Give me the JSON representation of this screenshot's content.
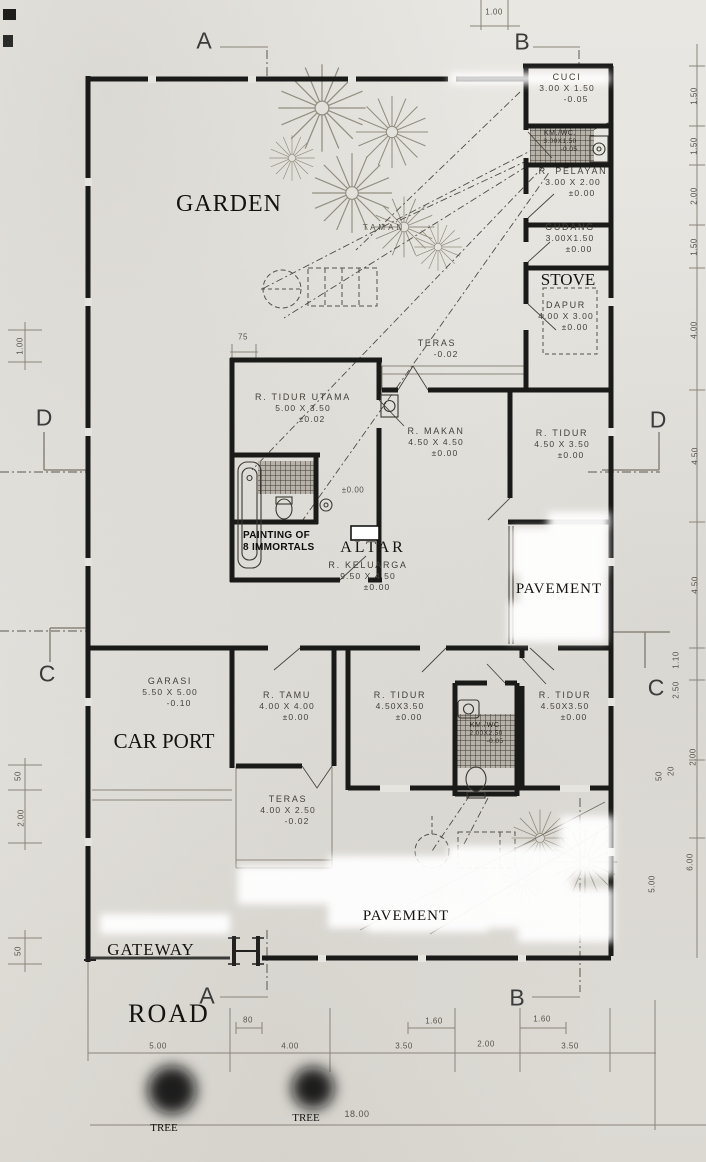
{
  "drawing": {
    "type": "house floor plan (feng-shui annotated site plan)",
    "accent_wall_color": "#1a1a19",
    "paper_color": "#e6e4df"
  },
  "grid": {
    "a": "A",
    "b": "B",
    "c": "C",
    "d": "D"
  },
  "rooms": [
    {
      "name": "CUCI",
      "size": "3.00 X 1.50",
      "level": "-0.05"
    },
    {
      "name": "KM./WC.",
      "size": "3.00X1.50",
      "level": "-0.05"
    },
    {
      "name": "R. PELAYAN",
      "size": "3.00 X 2.00",
      "level": "±0.00"
    },
    {
      "name": "GUDANG",
      "size": "3.00X1.50",
      "level": "±0.00"
    },
    {
      "name": "DAPUR",
      "size": "4.00 X 3.00",
      "level": "±0.00"
    },
    {
      "name": "TERAS",
      "size": "",
      "level": "-0.02"
    },
    {
      "name": "R. TIDUR UTAMA",
      "size": "5.00 X 3.50",
      "level": "±0.02"
    },
    {
      "name": "R. MAKAN",
      "size": "4.50 X 4.50",
      "level": "±0.00"
    },
    {
      "name": "R. TIDUR",
      "size": "4.50 X 3.50",
      "level": "±0.00"
    },
    {
      "name": "R. KELUARGA",
      "size": "9.50 X 4.50",
      "level": "±0.00"
    },
    {
      "name": "GARASI",
      "size": "5.50 X 5.00",
      "level": "-0.10"
    },
    {
      "name": "R. TAMU",
      "size": "4.00 X 4.00",
      "level": "±0.00"
    },
    {
      "name": "R. TIDUR",
      "size": "4.50X3.50",
      "level": "±0.00"
    },
    {
      "name": "KM./WC.",
      "size": "2.00X2.50",
      "level": "-0.05"
    },
    {
      "name": "R. TIDUR",
      "size": "4.50X3.50",
      "level": "±0.00"
    },
    {
      "name": "TERAS",
      "size": "4.00 X 2.50",
      "level": "-0.02"
    }
  ],
  "annotations": {
    "garden": "GARDEN",
    "taman": "TAMAN",
    "stove": "STOVE",
    "car_port": "CAR PORT",
    "painting_line1": "PAINTING OF",
    "painting_line2": "8 IMMORTALS",
    "altar": "ALTAR",
    "pavement_right": "PAVEMENT",
    "pavement_bottom": "PAVEMENT",
    "gateway": "GATEWAY",
    "road": "ROAD",
    "tree_1": "TREE",
    "tree_2": "TREE",
    "hall_level": "±0.00",
    "total_width": "18.00"
  },
  "dims": {
    "top": [
      "1.00",
      "75"
    ],
    "left": [
      "1.00",
      "50",
      "2.00",
      "50"
    ],
    "right": [
      "1.50",
      "1.50",
      "2.00",
      "1.50",
      "4.00",
      "4.50",
      "4.50",
      "1.10",
      "2.50",
      "2.00",
      "50",
      "20",
      "6.00",
      "5.00"
    ],
    "bottom": [
      "5.00",
      "80",
      "4.00",
      "3.50",
      "1.60",
      "2.00",
      "1.60",
      "3.50"
    ]
  }
}
